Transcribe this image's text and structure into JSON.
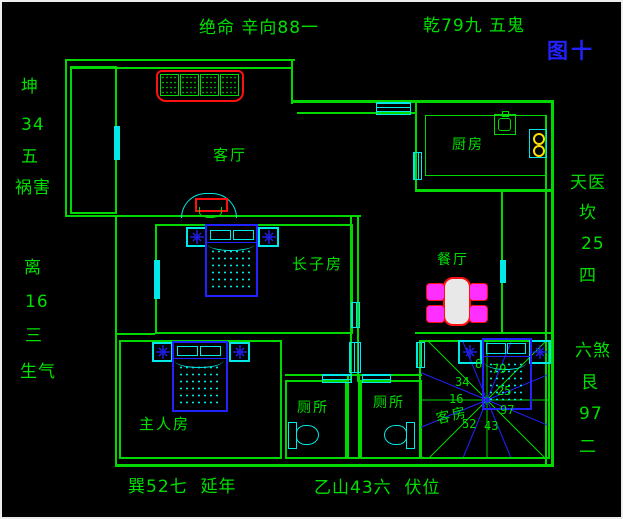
{
  "title": {
    "label": "图十"
  },
  "annotations": {
    "top_center": "绝命 辛向88一",
    "top_right": "乾79九 五鬼",
    "left_upper": [
      "坤",
      "34",
      "五",
      "祸害"
    ],
    "left_lower": [
      "离",
      "16",
      "三",
      "生气"
    ],
    "right_upper": [
      "天医",
      "坎",
      "25",
      "四"
    ],
    "right_lower": [
      "六煞",
      "艮",
      "97",
      "二"
    ],
    "bottom_left": "巽52七  延年",
    "bottom_center": "乙山43六  伏位"
  },
  "rooms": {
    "living_room": "客厅",
    "kitchen": "厨房",
    "eldest_son_room": "长子房",
    "dining_room": "餐厅",
    "master_room": "主人房",
    "toilet_left": "厕所",
    "toilet_right": "厕所",
    "guest_room": "客房"
  },
  "compass": {
    "numbers": [
      "8",
      "79",
      "34",
      "16",
      "25",
      "97",
      "52",
      "43"
    ]
  },
  "colors": {
    "wall_green": "#00d800",
    "text_green": "#00e000",
    "cyan": "#00e8e8",
    "blue": "#2222ff",
    "red": "#ff1010",
    "magenta": "#ff30ff",
    "yellow": "#ffe000",
    "background": "#000000"
  }
}
